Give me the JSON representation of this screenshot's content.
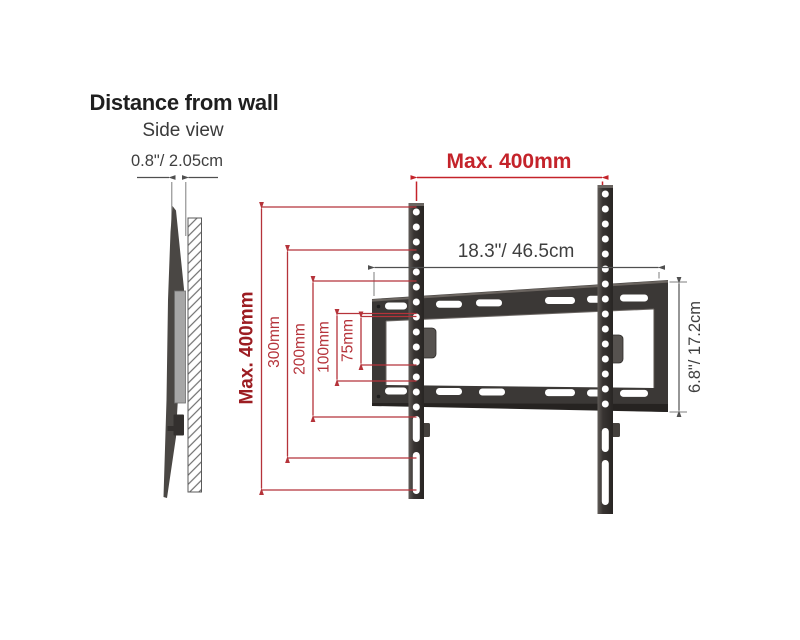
{
  "header": {
    "title": "Distance from wall",
    "subtitle": "Side view"
  },
  "side_view": {
    "gap_dimension": "0.8\"/ 2.05cm"
  },
  "front_view": {
    "max_width": "Max. 400mm",
    "max_height": "Max. 400mm",
    "plate_width": "18.3\"/ 46.5cm",
    "plate_height": "6.8\"/ 17.2cm",
    "vesa_vertical": [
      "300mm",
      "200mm",
      "100mm",
      "75mm"
    ]
  },
  "colors": {
    "accent_red": "#c4232a",
    "dark_red": "#9c1d22",
    "dim_red": "#b5333a",
    "ink": "#3f3f3f",
    "bracket_dark": "#36332f",
    "spacer_gray": "#a6a6a6"
  }
}
